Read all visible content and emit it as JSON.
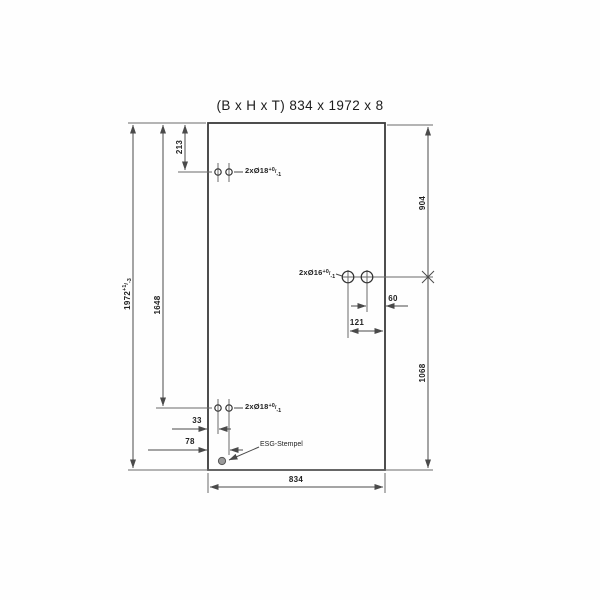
{
  "title": "(B x H x T) 834 x 1972 x 8",
  "dims": {
    "total_height": "1972",
    "total_height_tol_plus": "+1",
    "total_height_tol_minus": "-3",
    "bottom_holes_from_top": "1648",
    "top_holes_from_top": "213",
    "lock_row_from_top": "904",
    "lock_row_from_bottom": "1068",
    "lock_hole_to_edge": "60",
    "lock_hole_far_to_edge": "121",
    "hinge_hole1_from_edge": "33",
    "hinge_hole2_from_edge": "78",
    "width": "834"
  },
  "callouts": {
    "top_hinge_holes": {
      "label": "2xØ18",
      "tol_plus": "+0",
      "tol_minus": "-1"
    },
    "lock_holes": {
      "label": "2xØ16",
      "tol_plus": "+0",
      "tol_minus": "-1"
    },
    "bottom_hinge_holes": {
      "label": "2xØ18",
      "tol_plus": "+0",
      "tol_minus": "-1"
    },
    "stamp": "ESG-Stempel"
  },
  "colors": {
    "line": "#4a4a4a",
    "glass_edge": "#3a3a3a",
    "background": "#fefefe",
    "stamp_fill": "#9a9a9a"
  }
}
